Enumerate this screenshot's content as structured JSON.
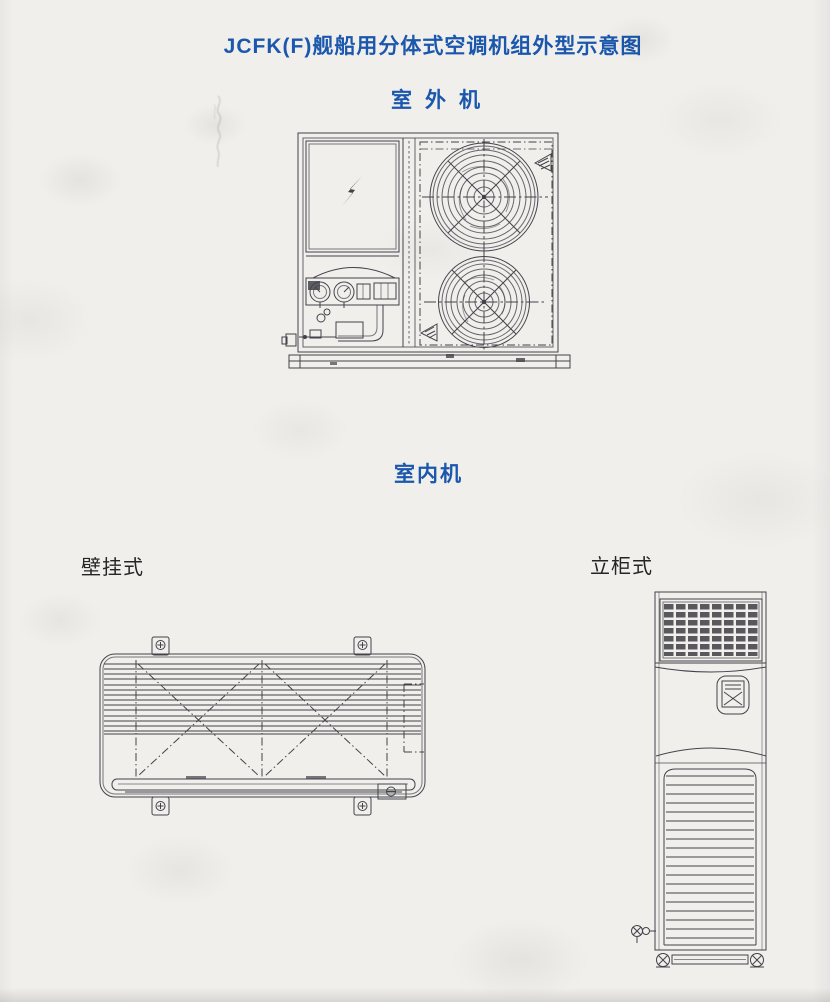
{
  "page": {
    "title": "JCFK(F)舰船用分体式空调机组外型示意图",
    "colors": {
      "title_blue": "#1a57ad",
      "ink": "#42424a",
      "paper": "#f0efec"
    }
  },
  "sections": {
    "outdoor_label": "室外机",
    "indoor_label": "室内机",
    "wall_type_label": "壁挂式",
    "cabinet_type_label": "立柜式"
  },
  "icons": {
    "outdoor_unit": [
      "lightning-icon",
      "pressure-gauge-icon",
      "pressure-gauge-icon",
      "fan-guard-icon",
      "fan-guard-icon",
      "corner-weld-mark-icon"
    ],
    "wall_unit": [
      "mounting-tab-screw-icon",
      "mounting-tab-screw-icon",
      "mounting-tab-screw-icon",
      "mounting-tab-screw-icon",
      "screw-plate-icon"
    ],
    "cabinet_unit": [
      "air-outlet-grille-icon",
      "control-panel-icon",
      "air-intake-louver-icon",
      "caster-bolt-icon",
      "caster-bolt-icon",
      "drain-valve-icon"
    ]
  }
}
